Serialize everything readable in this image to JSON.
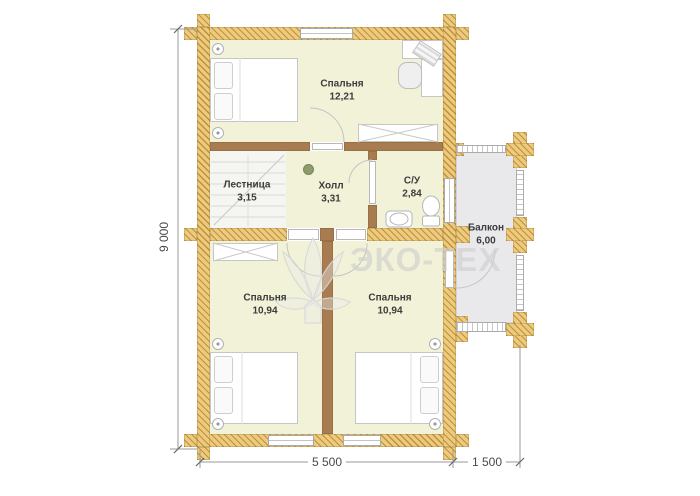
{
  "plan": {
    "watermark_text": "ЭКО-ТЕХ",
    "rooms": {
      "bedroom_top": {
        "name": "Спальня",
        "area": "12,21"
      },
      "stairs": {
        "name": "Лестница",
        "area": "3,15"
      },
      "hall": {
        "name": "Холл",
        "area": "3,31"
      },
      "bathroom": {
        "name": "С/У",
        "area": "2,84"
      },
      "balcony": {
        "name": "Балкон",
        "area": "6,00"
      },
      "bedroom_left": {
        "name": "Спальня",
        "area": "10,94"
      },
      "bedroom_right": {
        "name": "Спальня",
        "area": "10,94"
      }
    },
    "dimensions": {
      "total_height": "9 000",
      "main_width": "5 500",
      "balcony_width": "1 500"
    },
    "colors": {
      "wall_wood": "#e9c878",
      "wall_wood_stripe": "#c2913c",
      "partition_brown": "#a87c50",
      "floor_room": "#f2f2d9",
      "floor_stairs": "#f5f5f2",
      "floor_balcony": "#e9e9ec",
      "label_text": "#3c3c3c",
      "watermark": "#cdcdcd"
    }
  }
}
